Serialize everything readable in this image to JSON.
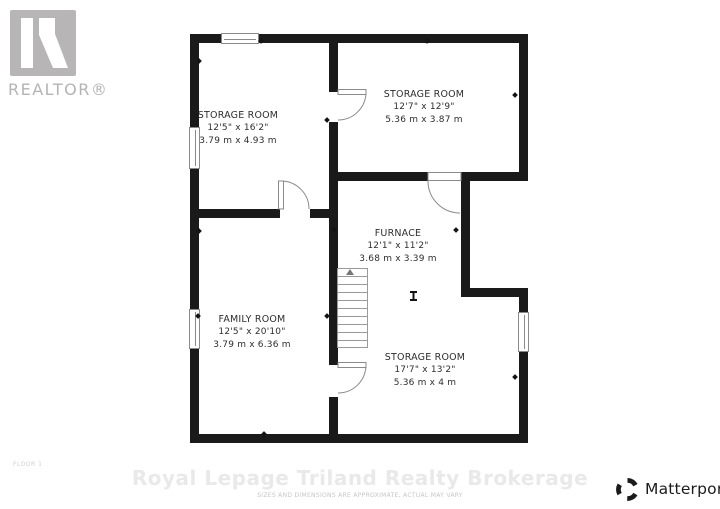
{
  "colors": {
    "wall": "#1a1a1a",
    "room_text": "#2e2e2e",
    "door_window": "#8a8a8a",
    "stairs": "#9a9a9a",
    "realtor_gray": "#b5b3b3",
    "watermark": "#e9e9e9",
    "fine_print": "#c6c6c6",
    "matterport_ink": "#1b1b1b"
  },
  "branding": {
    "realtor_logo": "realtor-r-logo",
    "realtor_label": "REALTOR®",
    "floor_label": "FLOOR 1",
    "watermark_text": "Royal Lepage Triland Realty Brokerage",
    "disclaimer": "SIZES AND DIMENSIONS ARE APPROXIMATE, ACTUAL MAY VARY",
    "matterport_icon": "matterport-logo",
    "matterport_label": "Matterport™"
  },
  "floorplan": {
    "rooms": [
      {
        "name": "STORAGE ROOM",
        "imperial": "12'5\" x 16'2\"",
        "metric": "3.79 m x 4.93 m"
      },
      {
        "name": "STORAGE ROOM",
        "imperial": "12'7\" x 12'9\"",
        "metric": "5.36 m x 3.87 m"
      },
      {
        "name": "FURNACE",
        "imperial": "12'1\" x 11'2\"",
        "metric": "3.68 m x 3.39 m"
      },
      {
        "name": "FAMILY ROOM",
        "imperial": "12'5\" x 20'10\"",
        "metric": "3.79 m x 6.36 m"
      },
      {
        "name": "STORAGE ROOM",
        "imperial": "17'7\" x 13'2\"",
        "metric": "5.36 m x 4 m"
      }
    ],
    "symbols": [
      "staircase",
      "door-swing",
      "window",
      "support-column"
    ]
  }
}
